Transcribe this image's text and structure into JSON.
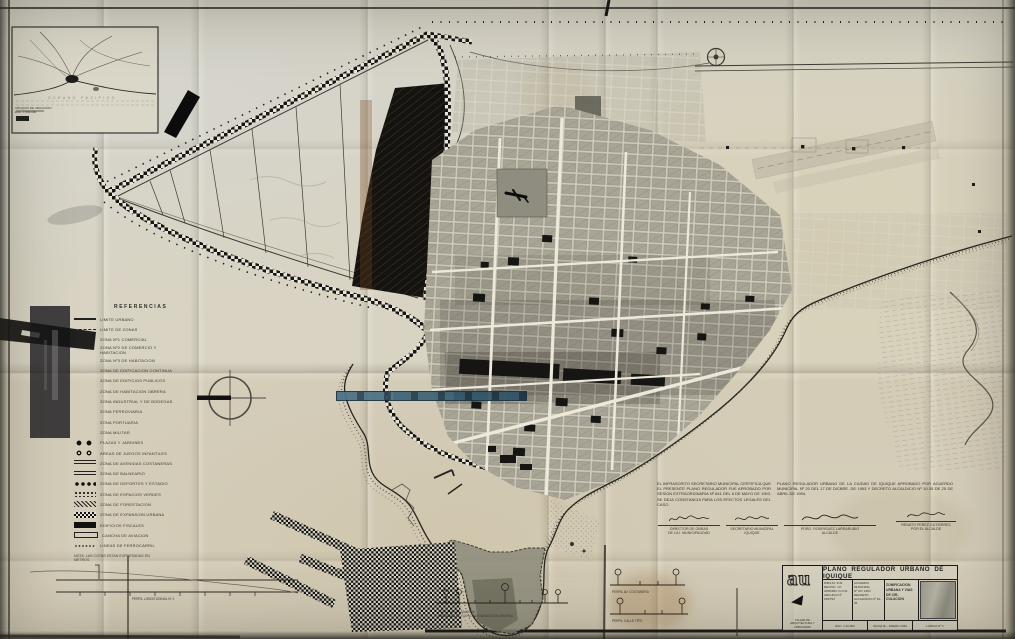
{
  "meta": {
    "title": "Plano Regulador Urbano de Iquique"
  },
  "colors": {
    "paper": "#d8d3c2",
    "ink": "#1c1c1c",
    "highlight_fill": "#3c6277",
    "highlight_border": "#16303f",
    "stain": "#b08a3c",
    "dune_black": "#141310"
  },
  "inset": {
    "caption": "CROQUIS DE UBICACION\nESC. 1:500.000",
    "sea_label": "OCEANO PACIFICO"
  },
  "legend": {
    "title": "REFERENCIAS",
    "items": [
      {
        "label": "LIMITE URBANO"
      },
      {
        "label": "LIMITE DE ZONAS"
      },
      {
        "label": "ZONA Nº1 COMERCIAL"
      },
      {
        "label": "ZONA Nº2 DE COMERCIO Y HABITACION"
      },
      {
        "label": "ZONA Nº3 DE HABITACION"
      },
      {
        "label": "ZONA DE EDIFICACION CONTINUA"
      },
      {
        "label": "ZONA DE EDIFICIOS PUBLICOS"
      },
      {
        "label": "ZONA DE HABITACION OBRERA"
      },
      {
        "label": "ZONA INDUSTRIAL Y DE BODEGAS"
      },
      {
        "label": "ZONA FERROVIARIA"
      },
      {
        "label": "ZONA PORTUARIA"
      },
      {
        "label": "ZONA MILITAR"
      },
      {
        "label": "PLAZAS Y JARDINES"
      },
      {
        "label": "AREAS DE JUEGOS INFANTILES"
      },
      {
        "label": "ZONA DE AVENIDAS COSTANERAS"
      },
      {
        "label": "ZONA DE BALNEARIO"
      },
      {
        "label": "ZONA DE DEPORTES Y ESTADIO"
      },
      {
        "label": "ZONA DE ESPACIOS VERDES"
      },
      {
        "label": "ZONA DE FORESTACION"
      },
      {
        "label": "ZONA DE EXPANSION URBANA"
      },
      {
        "label": "EDIFICIOS FISCALES"
      },
      {
        "label": "CANCHA DE AVIACION"
      },
      {
        "label": "LINEAS DE FERROCARRIL"
      }
    ],
    "note": "NOTA: LAS COTAS ESTAN EXPRESADAS EN METROS."
  },
  "cert": {
    "left_paragraph": "EL INFRASCRITO SECRETARIO MUNICIPAL CERTIFICA QUE EL PRESENTE PLANO REGULADOR FUE APROBADO POR SESION EXTRAORDINARIA Nº 841 DEL 6 DE MAYO DE 1953. SE DEJA CONSTANCIA PARA LOS EFECTOS LEGALES DEL CASO.",
    "right_paragraph": "PLANO REGULADOR URBANO DE LA CIUDAD DE IQUIQUE APROBADO POR ACUERDO MUNICIPAL Nº 20 DEL 17 DE DICBRE. DE 1953 Y DECRETO ALCALDICIO Nº 10-35 DE 25 DE ABRIL DE 1954.",
    "signatures": [
      {
        "name": "DIRECTOR DE OBRAS",
        "title": "DE LA I. MUNICIPALIDAD"
      },
      {
        "name": "SECRETARIO MUNICIPAL",
        "title": "IQUIQUE"
      },
      {
        "name": "PDRO. RODRIGUEZ LARRARUBIO",
        "title": "ALCALDE"
      },
      {
        "name": "RENATO PEREZ GUTIERREZ",
        "title": "POR EL ALCALDE"
      }
    ]
  },
  "profiles": {
    "caption_main": "PERFIL AV. BALMACEDA\nCALZADAS DE 9.00 M. CON BANDEJON CENTRAL",
    "caption_a": "PERFIL AV. COSTANERA",
    "caption_b": "PERFIL CALLE TIPO",
    "caption_long": "PERFIL LONGITUDINAL Nº 1"
  },
  "title_block": {
    "logo": "au",
    "logo_caption": "TALLER DE ARQUITECTURA Y URBANISMO",
    "title": "PLANO REGULADOR URBANO DE IQUIQUE",
    "col1": "DIBUJO: R.M.\nREVISO: J.P.\nAPROBO: D.O.M.\nARCHIVO Nº\n155/753",
    "col2": "ACUERDO MUNICIPAL\nNº 20 / 1953\nDECRETO\nALCALDICIO Nº 10-35",
    "subject": "ZONIFICACION URBANA Y VIAS DE CIR- CULACION",
    "footer": [
      "ESC. 1:10.000",
      "IQUIQUE – ENERO 1954",
      "LAMINA Nº 1"
    ]
  }
}
